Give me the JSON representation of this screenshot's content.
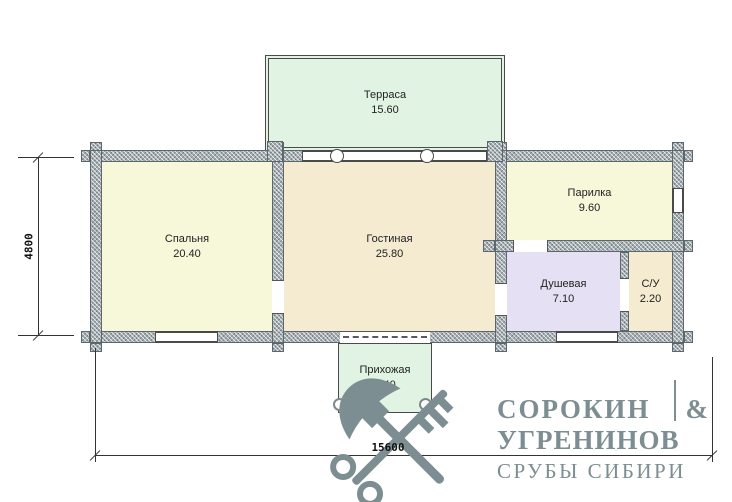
{
  "plan": {
    "rooms": [
      {
        "name": "Терраса",
        "area": "15.60",
        "fill": "#e1f3e2"
      },
      {
        "name": "Спальня",
        "area": "20.40",
        "fill": "#f7f7da"
      },
      {
        "name": "Гостиная",
        "area": "25.80",
        "fill": "#f4ebd0"
      },
      {
        "name": "Парилка",
        "area": "9.60",
        "fill": "#f7f7da"
      },
      {
        "name": "Душевая",
        "area": "7.10",
        "fill": "#e5e0f4"
      },
      {
        "name": "С/У",
        "area": "2.20",
        "fill": "#f4ebd0"
      },
      {
        "name": "Прихожая",
        "area": "5.40",
        "fill": "#e1f3e2"
      }
    ],
    "colors": {
      "wall": "#a3adb1",
      "line": "#4a4a4a"
    }
  },
  "dimensions": {
    "width": "15600",
    "height": "4800"
  },
  "watermark": {
    "name_line1": "СОРОКИН",
    "ampersand": "&",
    "name_line2": "УГРЕНИНОВ",
    "tagline": "СРУБЫ СИБИРИ",
    "color": "#7c8e91",
    "icon": "crossed-axe-and-key"
  }
}
